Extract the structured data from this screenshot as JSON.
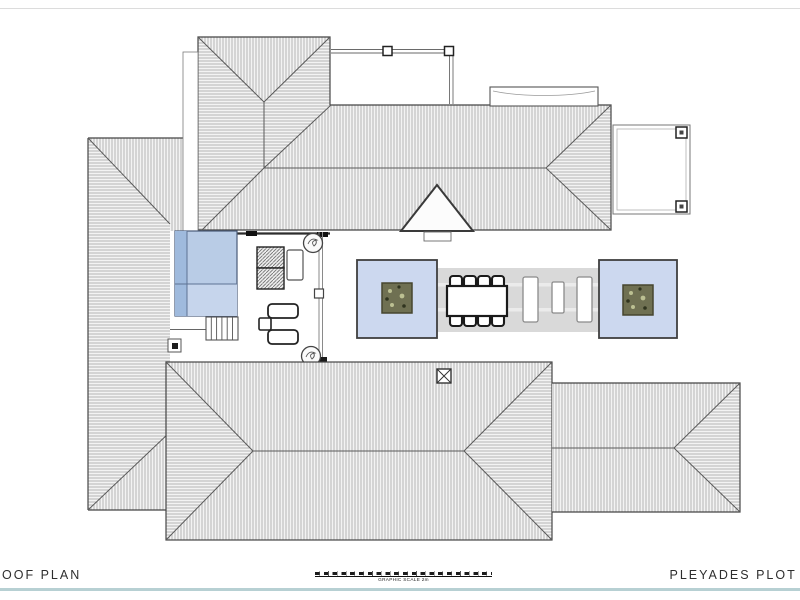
{
  "titleblock": {
    "drawing_title": "ROOF PLAN",
    "project_title": "PLEYADES PLOT N",
    "scale_caption": "GRAPHIC SCALE 2m"
  },
  "colors": {
    "pool_blue": "#b9cce6",
    "pool_blue_dark": "#9fbadd",
    "pool_blue_light": "#c6d5ec",
    "panel_blue": "#ccd8ef",
    "planter_olive": "#6f7052",
    "planter_speck_light": "#bcc092",
    "planter_speck_dark": "#30341f",
    "walkway_gray": "#d9d9d9",
    "walkway_stripe": "#ebebeb",
    "roof_fill": "#f3f3f3",
    "hatch_line": "#a6a6a6",
    "outline_dark": "#454545",
    "separator_teal": "#b7d0d3",
    "text_color": "#2e2e2e"
  },
  "plan_summary": {
    "dining_chairs": 8,
    "garden_planter_boxes": 2,
    "courtyard_pot_plants": 2,
    "roof_hatches": 1
  }
}
